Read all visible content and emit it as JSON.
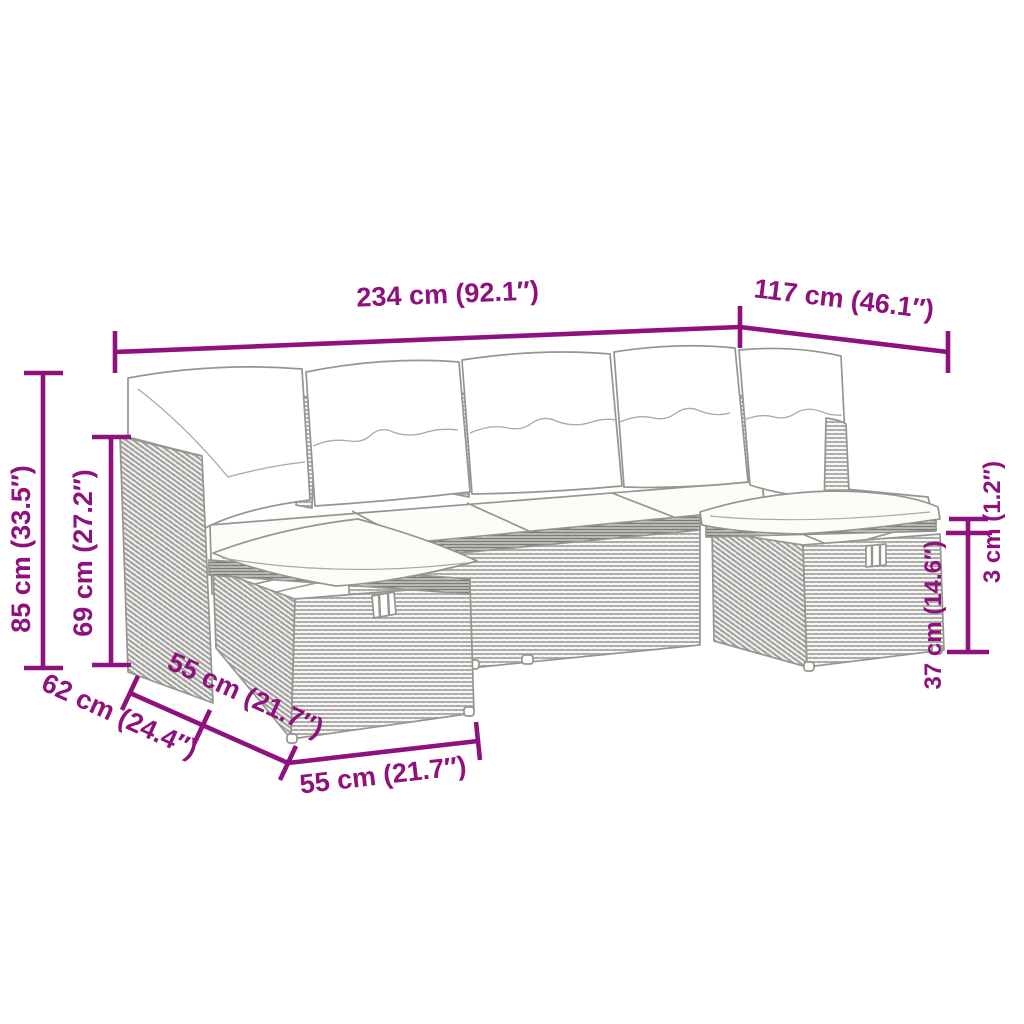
{
  "meta": {
    "title": "Garden furniture set dimension diagram",
    "background_color": "#FFFFFF",
    "accent_color": "#8E117D",
    "line_art_color": "#9A9896",
    "wicker_color": "#B3B1AD",
    "cushion_color": "#FFFFFF",
    "subject": "Modular poly rattan garden lounge set (corner sofa with back cushions, seat cushions and two ottoman stools) drawn as gray line art with magenta dimension annotations"
  },
  "dimensions": {
    "total_width": "234 cm (92.1″)",
    "total_depth": "117 cm (46.1″)",
    "total_height": "85 cm (33.5″)",
    "back_height": "69 cm (27.2″)",
    "cushion_thickness": "3 cm (1.2″)",
    "stool_height": "37 cm (14.6″)",
    "seat_depth": "62 cm (24.4″)",
    "stool_depth": "55 cm (21.7″)",
    "stool_width": "55 cm (21.7″)"
  }
}
